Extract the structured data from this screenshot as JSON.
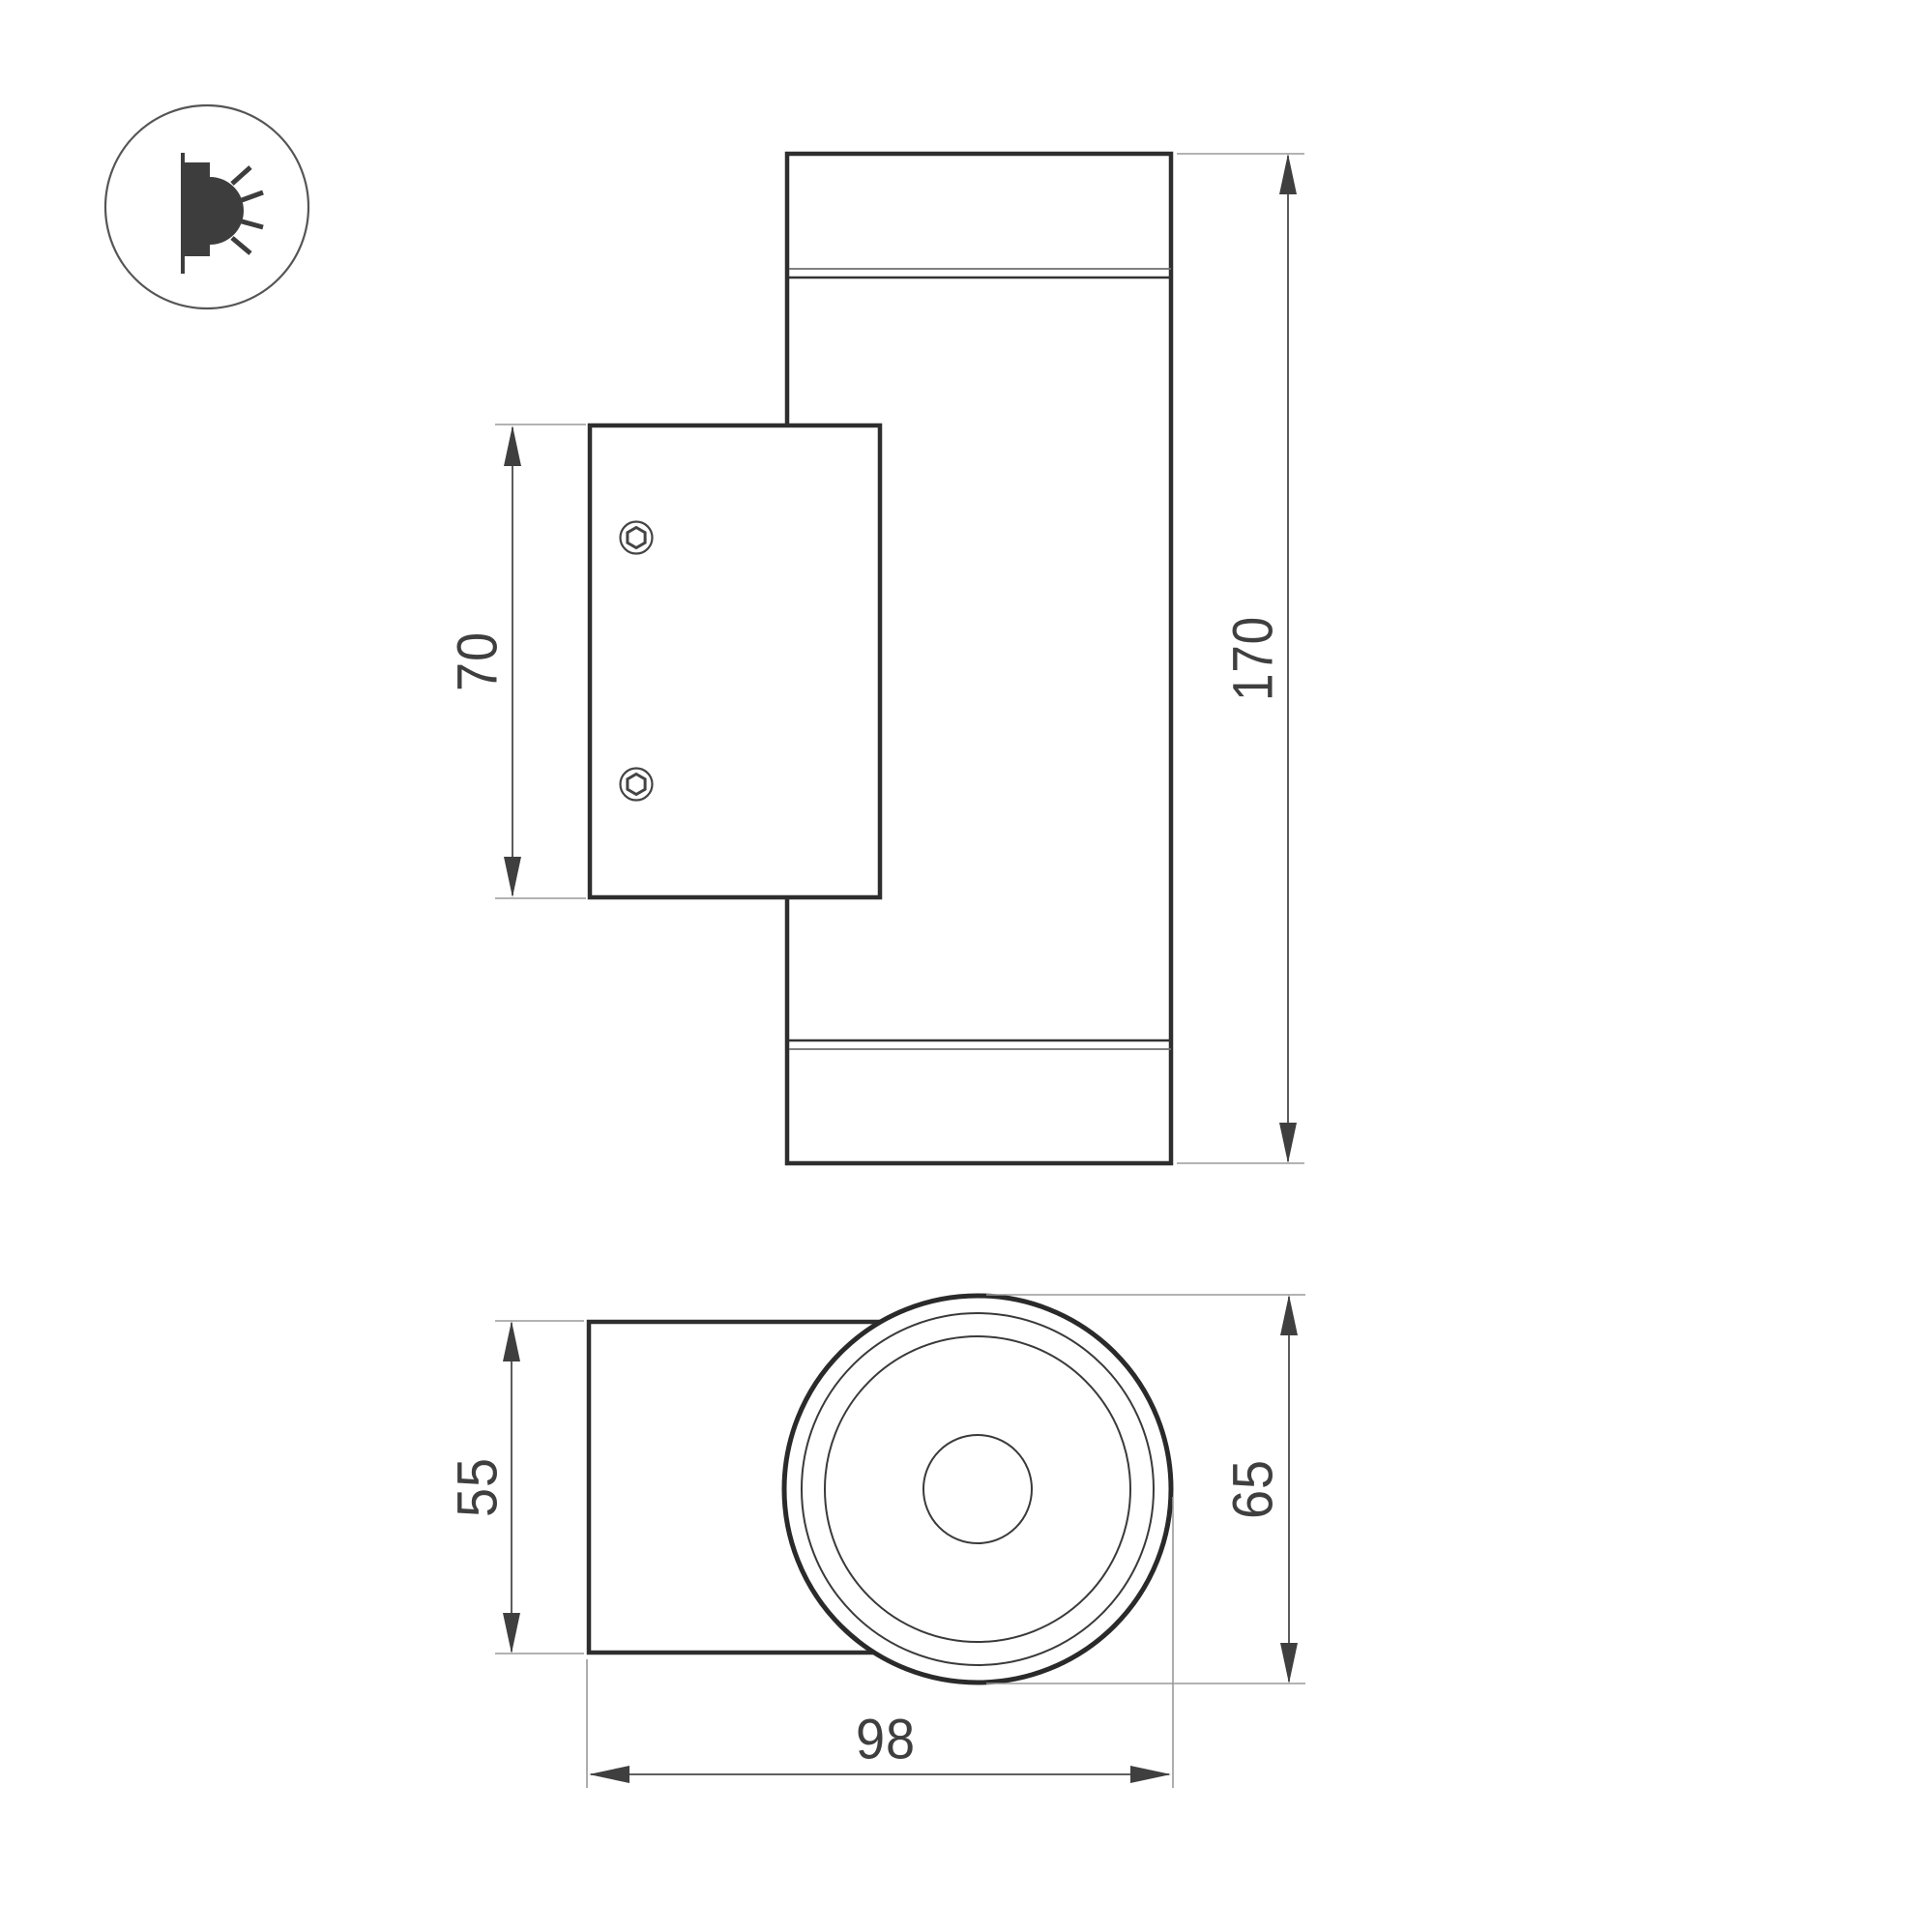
{
  "legend": {
    "icon": "wall-mounted-light-icon"
  },
  "dimensions": {
    "plate_height": "70",
    "overall_height": "170",
    "bracket_height": "55",
    "body_diameter": "65",
    "overall_depth": "98"
  },
  "colors": {
    "background": "#ffffff",
    "outline": "#2e2e2e",
    "detail_line": "#3a3a3a",
    "dimension_line": "#4a4a4a",
    "extension_line": "#9a9a9a",
    "arrow": "#3f3f3f",
    "text": "#3f3f3f"
  }
}
